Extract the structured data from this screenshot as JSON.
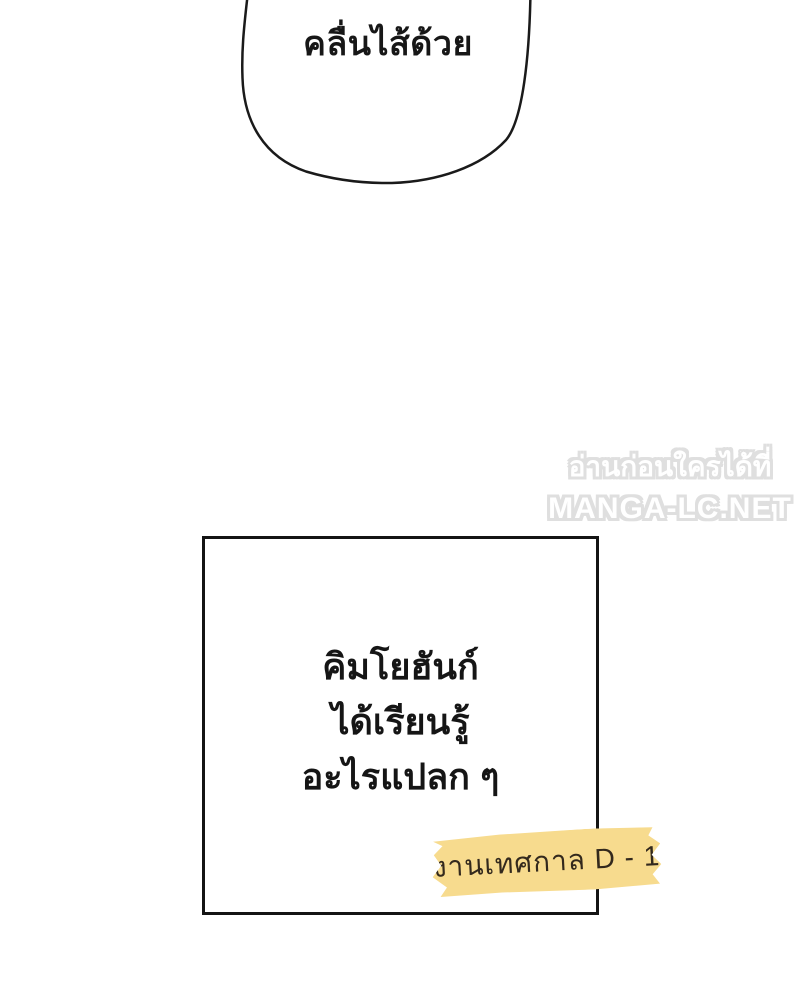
{
  "page": {
    "background_color": "#ffffff",
    "type": "manhwa-panel"
  },
  "speech_bubble": {
    "text": "คลื่นไส้ด้วย",
    "fill_color": "#ffffff",
    "border_color": "#1a1a1a"
  },
  "watermark": {
    "line1": "อ่านก่อนใครได้ที่",
    "line2": "MANGA-LC.NET",
    "fill_color": "#ffffff",
    "outline_color": "#dfdfdf"
  },
  "narration_box": {
    "lines": [
      "คิมโยฮันก์",
      "ได้เรียนรู้",
      "อะไรแปลก ๆ"
    ],
    "border_color": "#141414",
    "fill_color": "#ffffff"
  },
  "tape_label": {
    "text": "งานเทศกาล D - 1",
    "background_color": "#f7db8e",
    "text_color": "#33291d"
  }
}
